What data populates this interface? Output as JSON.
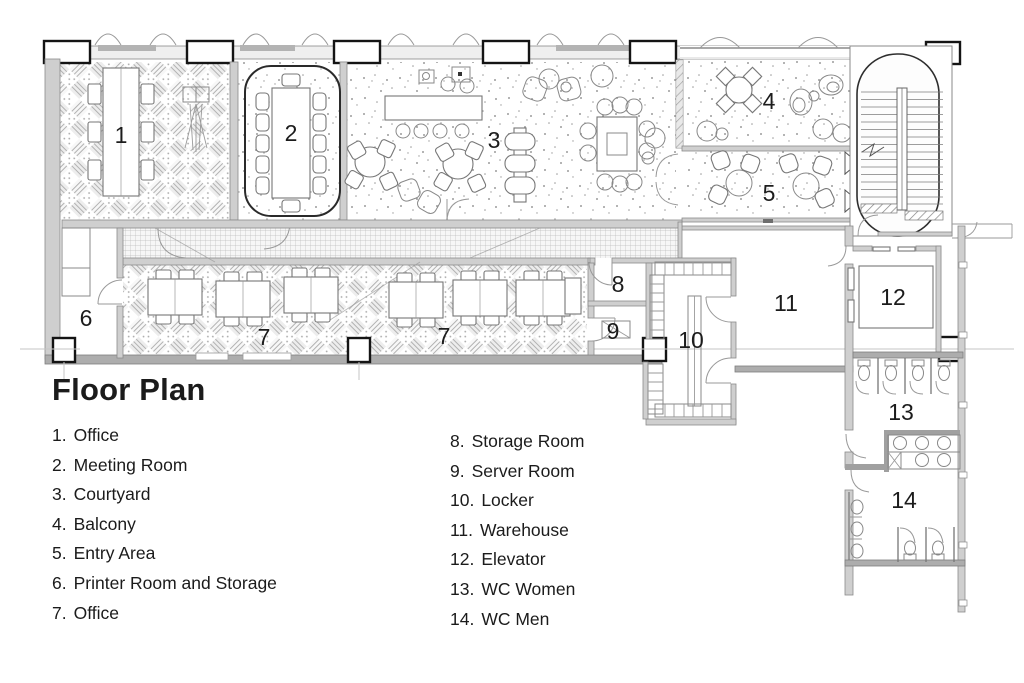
{
  "title": "Floor Plan",
  "legend": {
    "column1": [
      {
        "num": "1.",
        "label": "Office"
      },
      {
        "num": "2.",
        "label": "Meeting Room"
      },
      {
        "num": "3.",
        "label": "Courtyard"
      },
      {
        "num": "4.",
        "label": "Balcony"
      },
      {
        "num": "5.",
        "label": "Entry Area"
      },
      {
        "num": "6.",
        "label": "Printer Room and Storage"
      },
      {
        "num": "7.",
        "label": "Office"
      }
    ],
    "column2": [
      {
        "num": "8.",
        "label": "Storage Room"
      },
      {
        "num": "9.",
        "label": "Server Room"
      },
      {
        "num": "10.",
        "label": "Locker"
      },
      {
        "num": "11.",
        "label": "Warehouse"
      },
      {
        "num": "12.",
        "label": "Elevator"
      },
      {
        "num": "13.",
        "label": "WC Women"
      },
      {
        "num": "14.",
        "label": "WC Men"
      }
    ]
  },
  "plan": {
    "labels": {
      "r1": "1",
      "r2": "2",
      "r3": "3",
      "r4": "4",
      "r5": "5",
      "r6": "6",
      "r7a": "7",
      "r7b": "7",
      "r8": "8",
      "r9": "9",
      "r10": "10",
      "r11": "11",
      "r12": "12",
      "r13": "13",
      "r14": "14"
    }
  }
}
